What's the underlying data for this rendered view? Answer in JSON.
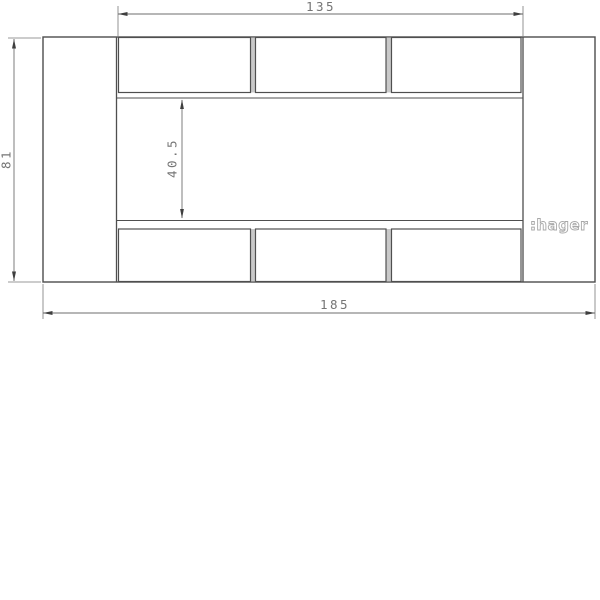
{
  "drawing": {
    "logo": ":hager",
    "dimensions": {
      "overall_width": "185",
      "overall_height": "81",
      "opening_width": "135",
      "opening_height": "40.5"
    },
    "layout": {
      "top_row_modules": 3,
      "bottom_row_modules": 3
    },
    "colors": {
      "outline": "#4d4d4d",
      "dimension_line": "#6e6e6e",
      "dimension_text": "#757575",
      "logo_outline": "#a8a8a8",
      "background": "#ffffff"
    }
  }
}
